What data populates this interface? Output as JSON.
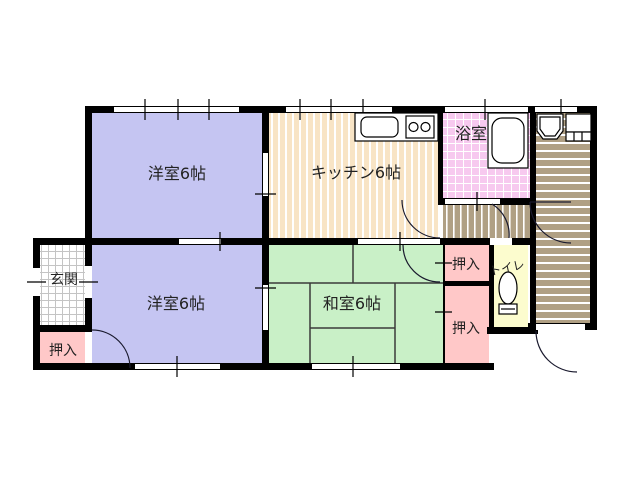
{
  "plan": {
    "type": "floor-plan",
    "rooms": {
      "western1": {
        "label": "洋室6帖",
        "color": "#c5c5f2"
      },
      "kitchen": {
        "label": "キッチン6帖",
        "color": "#f8e4c5",
        "stripe": "#ffffff"
      },
      "bath": {
        "label": "浴室",
        "color": "#f7c9ef",
        "grid": "#ffffff"
      },
      "western2": {
        "label": "洋室6帖",
        "color": "#c5c5f2"
      },
      "washitsu": {
        "label": "和室6帖",
        "color": "#c9f0c7"
      },
      "genkan": {
        "label": "玄関",
        "color": "#ffffff",
        "grid": "#c4c4c4"
      },
      "oshiire_entry": {
        "label": "押入",
        "color": "#ffc8c8"
      },
      "oshiire_top": {
        "label": "押入",
        "color": "#ffc8c8"
      },
      "oshiire_bottom": {
        "label": "押入",
        "color": "#ffc8c8"
      },
      "toilet": {
        "label": "トイレ",
        "color": "#fcfcce"
      },
      "corridor": {
        "color": "#b0a084",
        "stripe": "#ffffff"
      },
      "vestibule": {
        "color": "#b0a084",
        "stripe": "#ffffff"
      }
    },
    "icons": {
      "sink": "kitchen-sink",
      "stove": "two-burner-stove",
      "bathtub": "bathtub",
      "washbasin": "washbasin",
      "washer": "washing-machine-pan",
      "toilet": "toilet-bowl"
    },
    "colors": {
      "wall": "#000000",
      "line": "#1a1a1a",
      "background": "#ffffff"
    }
  }
}
